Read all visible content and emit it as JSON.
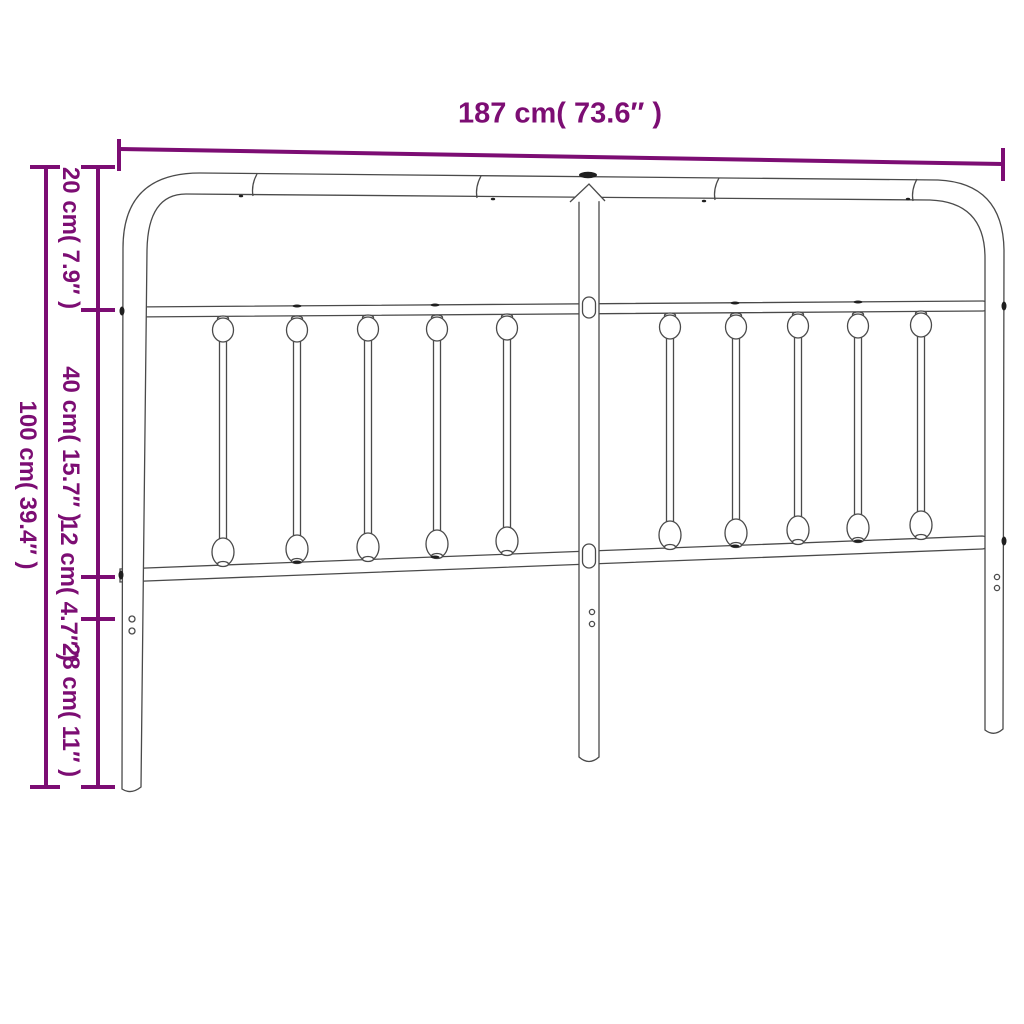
{
  "diagram": {
    "subject": "metal-headboard-dimension-diagram",
    "dimensions": {
      "width": {
        "cm": 187,
        "inches": 73.6,
        "label": "187 cm( 73.6″ )"
      },
      "total_height": {
        "cm": 100,
        "inches": 39.4,
        "label": "100 cm( 39.4″ )"
      },
      "left_segments": [
        {
          "cm": 20,
          "inches": 7.9,
          "label": "20 cm( 7.9″ )"
        },
        {
          "cm": 40,
          "inches": 15.7,
          "label": "40 cm( 15.7″ )"
        },
        {
          "cm": 12,
          "inches": 4.7,
          "label": "12 cm( 4.7″ )"
        },
        {
          "cm": 28,
          "inches": 11,
          "label": "28 cm( 11″ )"
        }
      ]
    },
    "colors": {
      "dimension_lines": "#7c0d73",
      "drawing_outline": "#4a4a4a",
      "background": "#ffffff"
    }
  }
}
